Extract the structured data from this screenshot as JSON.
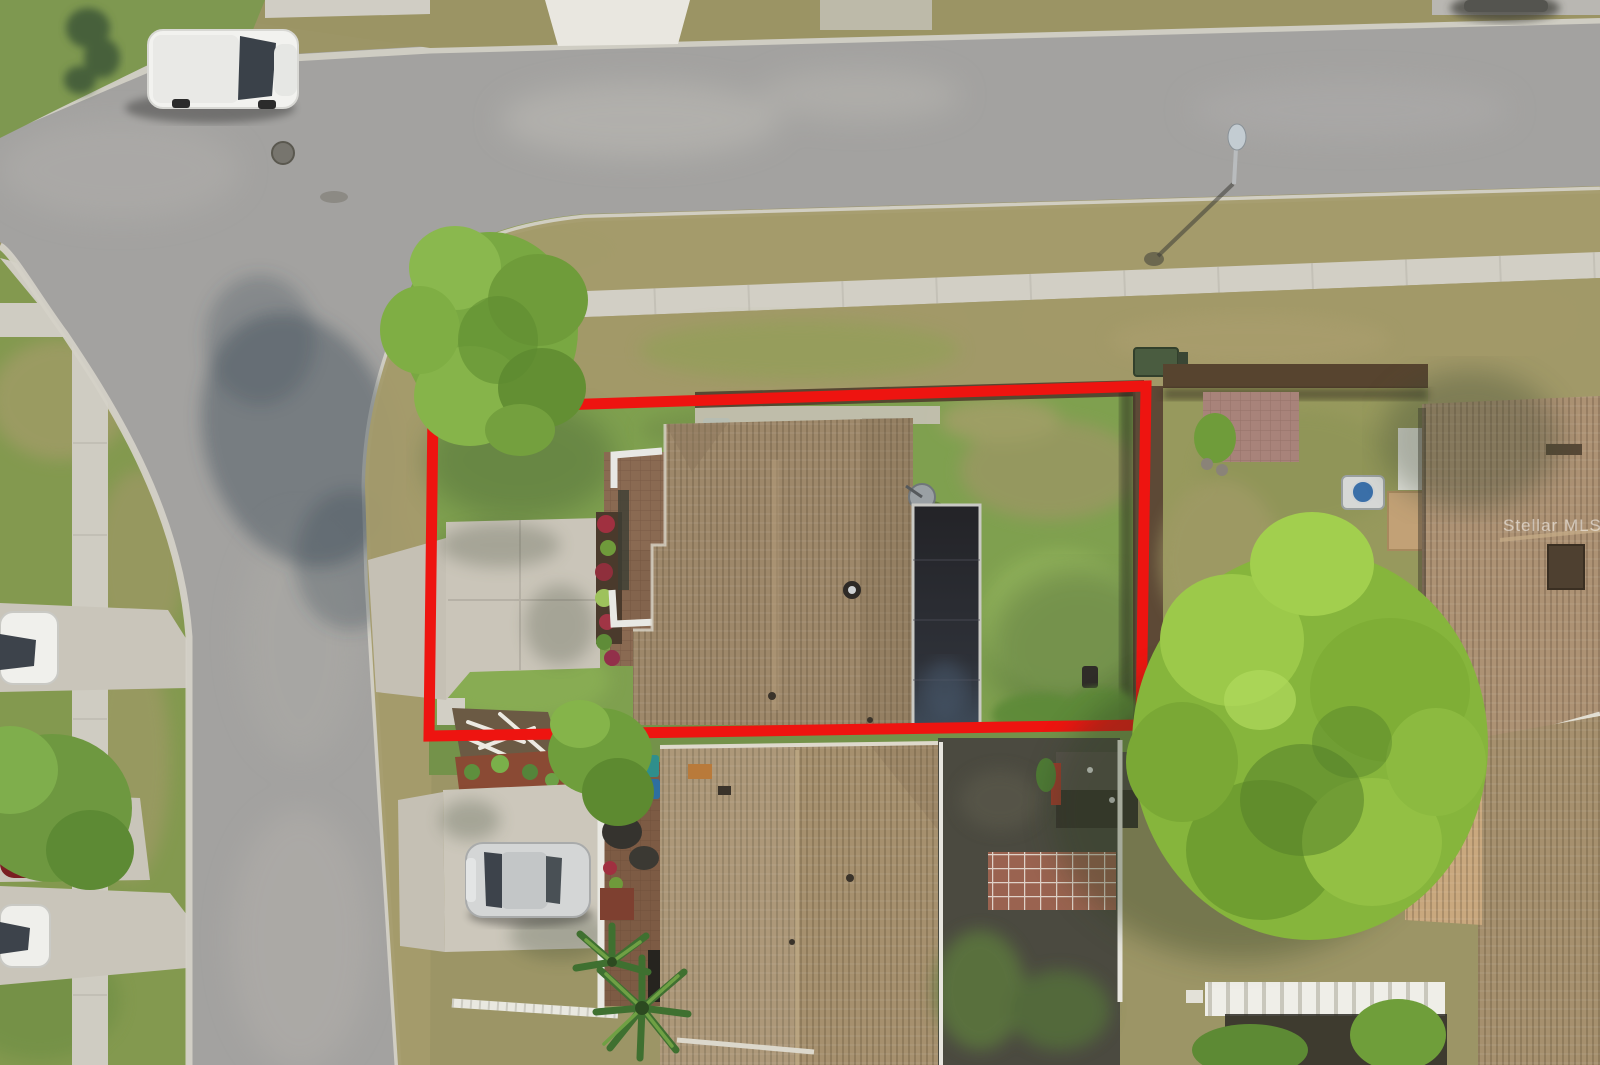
{
  "photo": {
    "type": "aerial-drone-photograph",
    "scene": "Top-down aerial view of a residential corner lot with house, driveway and fenced backyard, outlined in red; surrounding streets, sidewalks, neighboring homes, parked vehicles and trees",
    "watermark": "Stellar MLS",
    "outlined_property": {
      "boundary_color": "#ee1410"
    }
  },
  "colors": {
    "asphalt": "#a3a2a0",
    "scrub_base": "#9c9566",
    "lot_grass": "#7fa04f",
    "west_grass": "#83994f",
    "sidewalk": "#d3d0c6",
    "driveway": "#cac5b9",
    "roof_subject": "#9e886a",
    "roof_front": "#a6906e",
    "roof_right": "#ad9274",
    "roof_garage": "#c9a87e",
    "tree_green": "#86b53c",
    "screen_enclosure": "#2a2b30",
    "fence_brown": "#5d4936"
  }
}
